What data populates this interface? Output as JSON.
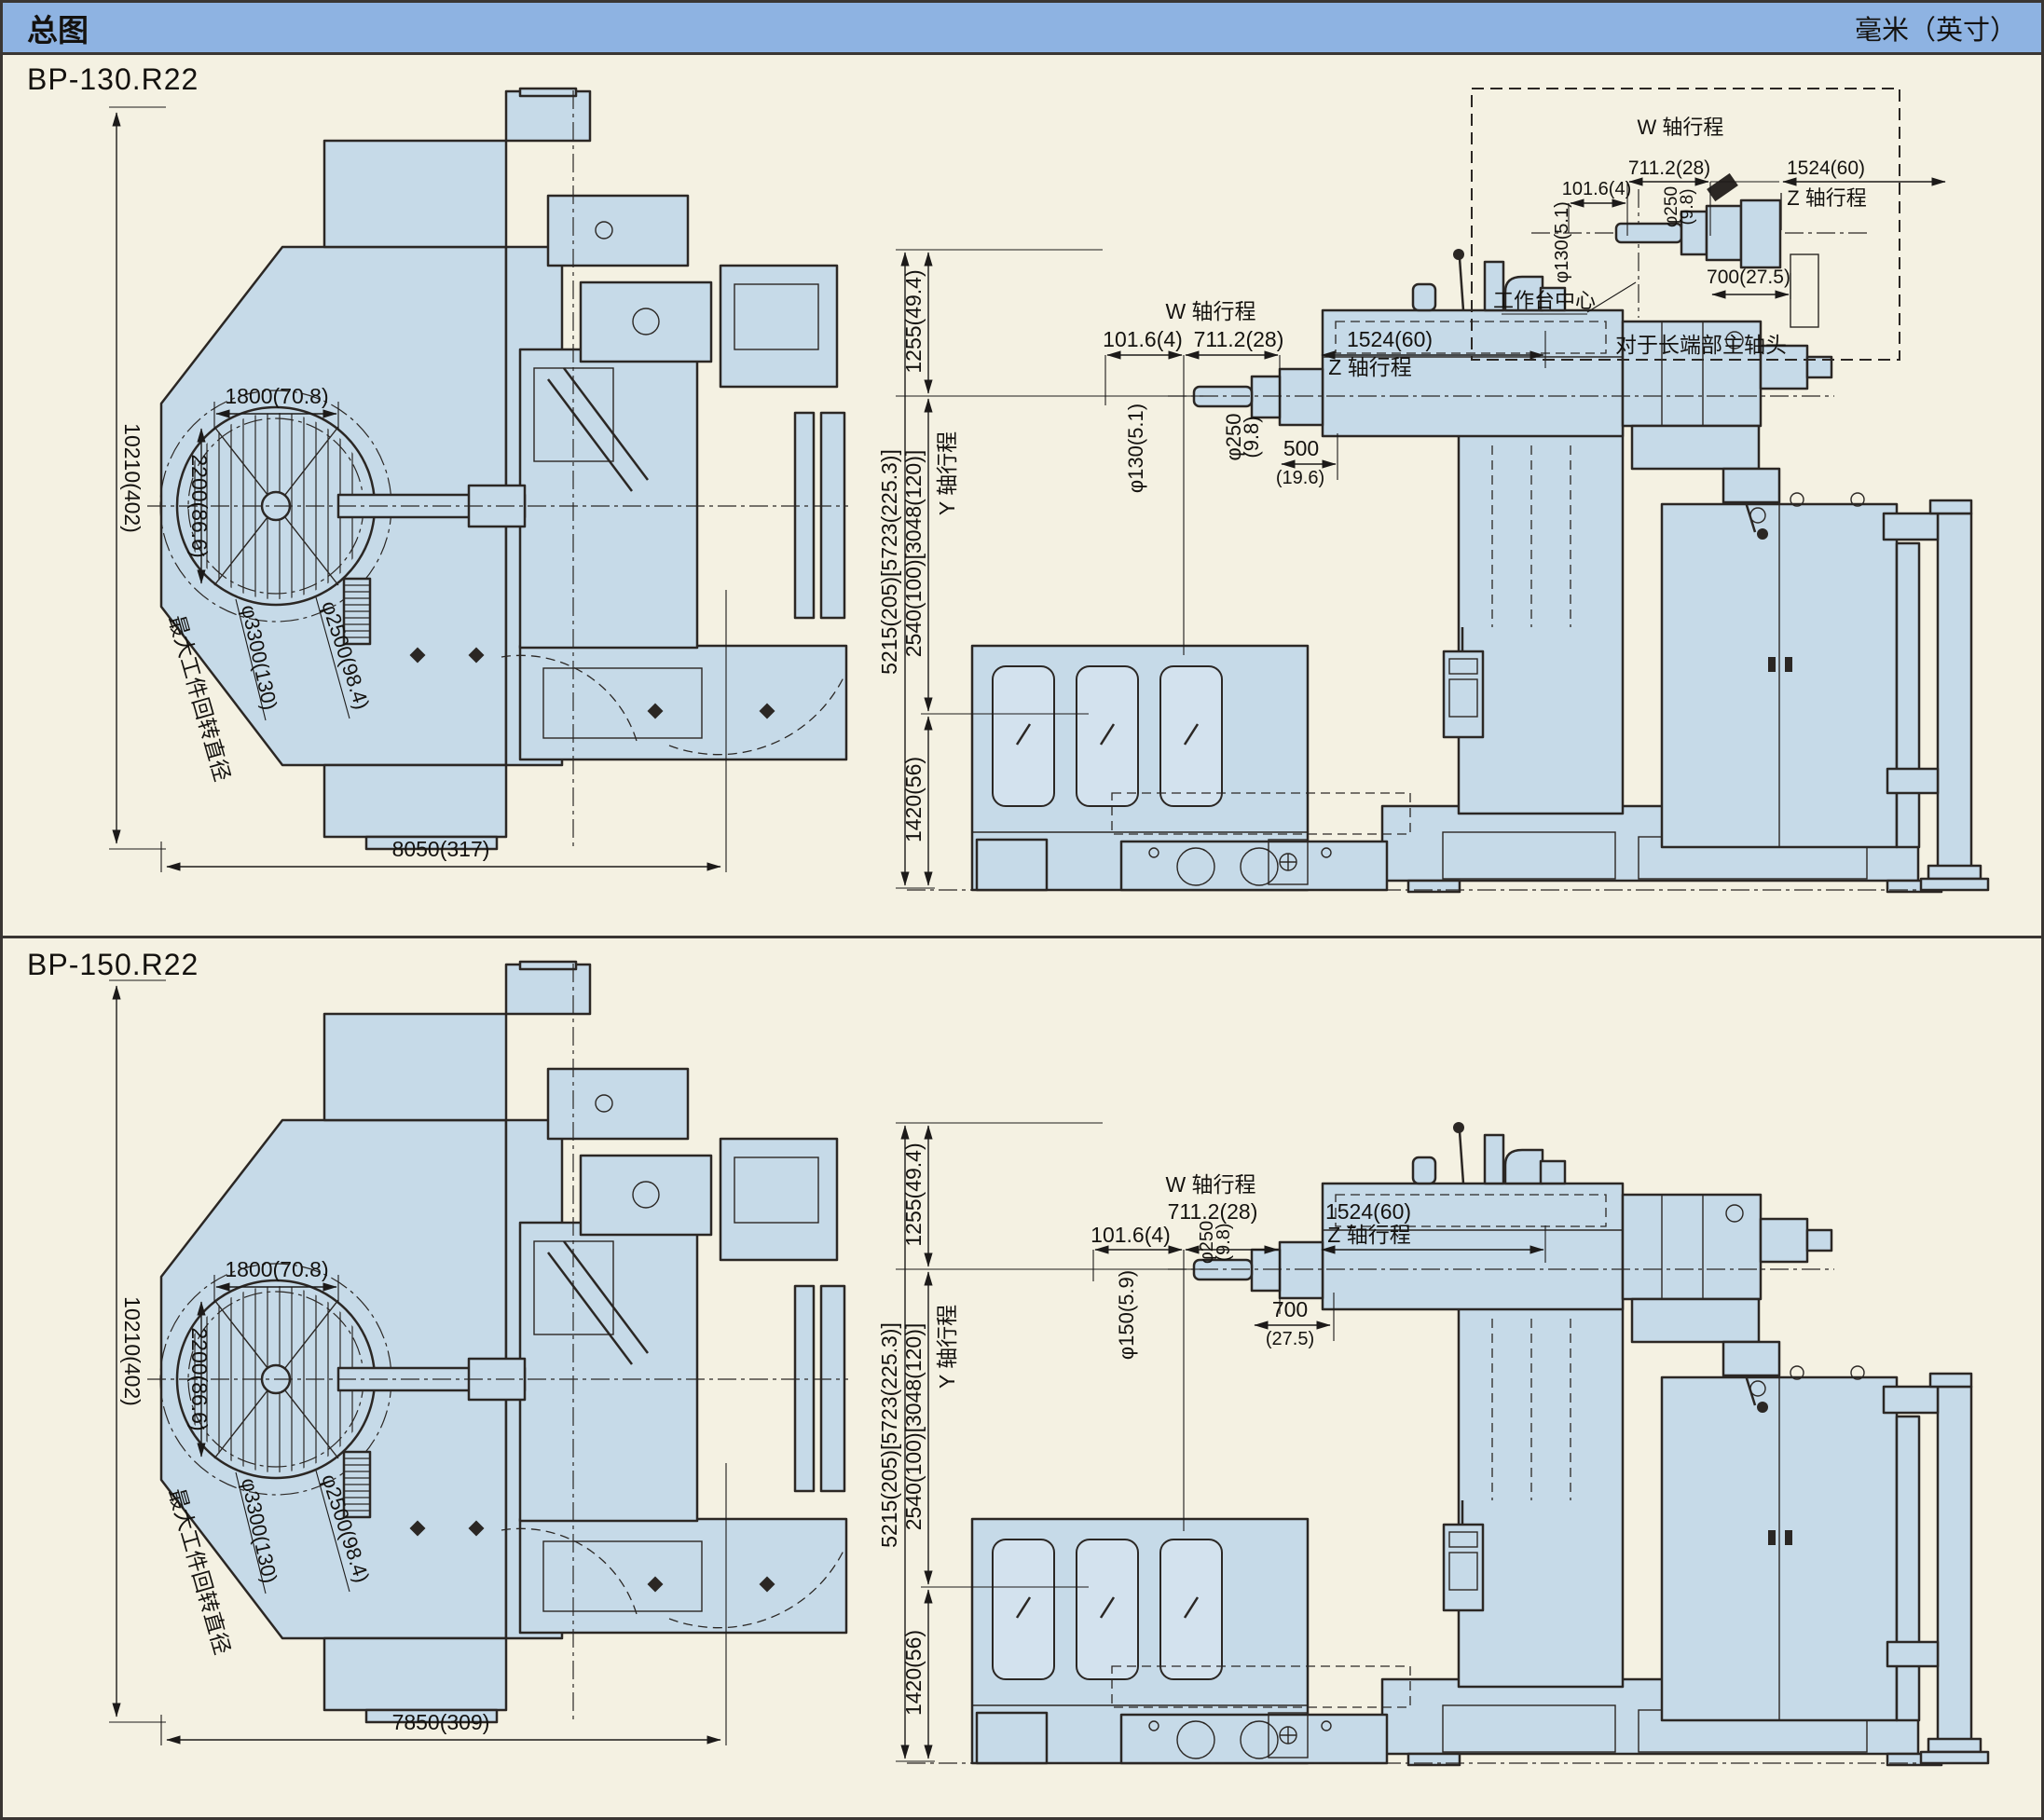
{
  "header": {
    "title": "总图",
    "units_note": "毫米（英寸）"
  },
  "colors": {
    "header_bg": "#8eb3e2",
    "page_bg": "#f4f1e2",
    "machine_fill": "#c6dae8",
    "line": "#2b2724",
    "dim_text": "#14120f"
  },
  "sections": [
    {
      "model": "BP-130.R22",
      "top_view": {
        "overall_depth": "10210(402)",
        "overall_length": "8050(317)",
        "table_width": "1800(70.8)",
        "table_depth": "2200(86.6)",
        "max_swing_label": "最大工件回转直径",
        "max_swing_dia": "φ3300(130)",
        "table_dia": "φ2500(98.4)"
      },
      "side_view": {
        "w_axis_label": "W 轴行程",
        "w_extra": "101.6(4)",
        "w_travel": "711.2(28)",
        "z_travel": "1524(60)",
        "z_axis_label": "Z 轴行程",
        "spindle_dia": "φ130(5.1)",
        "quill_dia": "φ250",
        "quill_dia_inch": "(9.8)",
        "quill_ext": "500",
        "quill_ext_inch": "(19.6)",
        "overall_height": "5215(205)[5723(225.3)]",
        "top_segment": "1255(49.4)",
        "y_axis_label": "Y 轴行程",
        "y_travel": "2540(100)[3048(120)]",
        "base_segment": "1420(56)"
      },
      "inset": {
        "w_axis_label": "W 轴行程",
        "w_extra": "101.6(4)",
        "w_travel": "711.2(28)",
        "z_travel": "1524(60)",
        "z_axis_label": "Z 轴行程",
        "spindle_dia": "φ130(5.1)",
        "quill_dia": "φ250",
        "quill_dia_inch": "(9.8)",
        "head_ext": "700(27.5)",
        "table_center_label": "工作台中心",
        "caption": "对于长端部主轴头"
      }
    },
    {
      "model": "BP-150.R22",
      "top_view": {
        "overall_depth": "10210(402)",
        "overall_length": "7850(309)",
        "table_width": "1800(70.8)",
        "table_depth": "2200(86.6)",
        "max_swing_label": "最大工件回转直径",
        "max_swing_dia": "φ3300(130)",
        "table_dia": "φ2500(98.4)"
      },
      "side_view": {
        "w_axis_label": "W 轴行程",
        "w_extra": "101.6(4)",
        "w_travel": "711.2(28)",
        "z_travel": "1524(60)",
        "z_axis_label": "Z 轴行程",
        "spindle_dia": "φ150(5.9)",
        "quill_dia": "φ250",
        "quill_dia_inch": "(9.8)",
        "quill_ext": "700",
        "quill_ext_inch": "(27.5)",
        "overall_height": "5215(205)[5723(225.3)]",
        "top_segment": "1255(49.4)",
        "y_axis_label": "Y 轴行程",
        "y_travel": "2540(100)[3048(120)]",
        "base_segment": "1420(56)"
      }
    }
  ]
}
